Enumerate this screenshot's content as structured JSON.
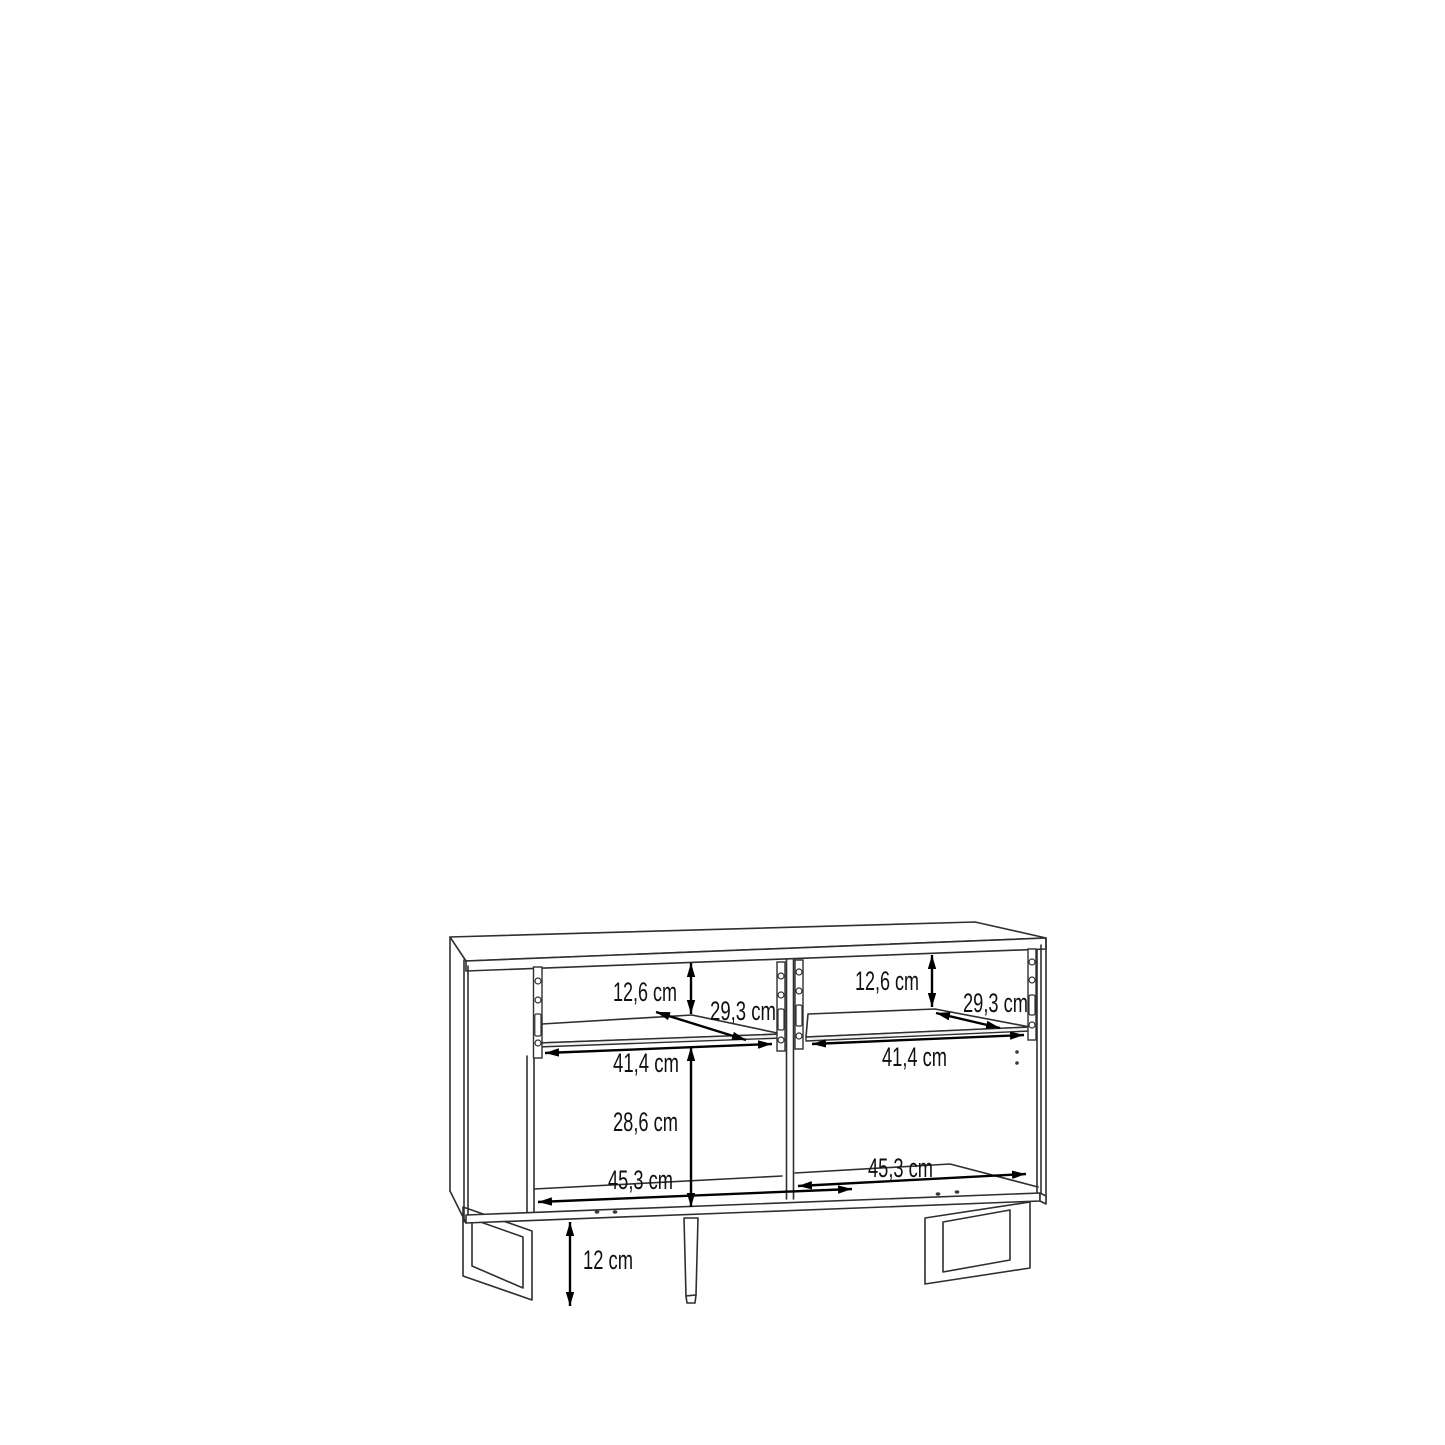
{
  "page": {
    "background": "#ffffff",
    "drawing_line_color": "#2f2f2f",
    "dimension_color": "#000000"
  },
  "dims": {
    "left_inner_height": "12,6 cm",
    "left_depth": "29,3 cm",
    "left_inner_width": "41,4 cm",
    "left_lower_inner_height": "28,6 cm",
    "left_bottom_inner_width": "45,3 cm",
    "right_inner_height": "12,6 cm",
    "right_depth": "29,3 cm",
    "right_inner_width": "41,4 cm",
    "right_bottom_inner_width": "45,3 cm",
    "leg_height": "12 cm"
  }
}
